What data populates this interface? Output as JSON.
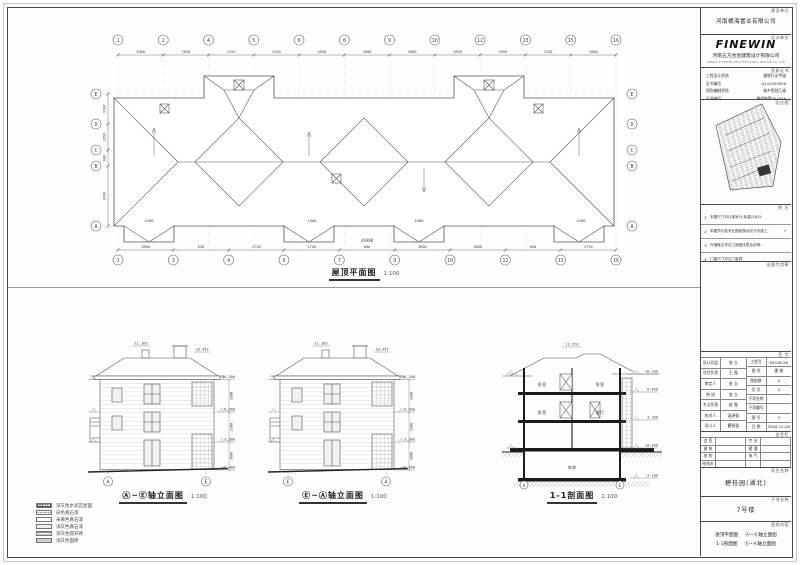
{
  "plan": {
    "title": "屋顶平面图",
    "scale": "1:100",
    "grid_top": [
      "1",
      "2",
      "4",
      "5",
      "6",
      "8",
      "9",
      "10",
      "12",
      "13",
      "15",
      "16"
    ],
    "dims_top": [
      "3000",
      "2850",
      "3150",
      "2550",
      "2850",
      "3000",
      "3000",
      "2850",
      "2850",
      "3150",
      "3000"
    ],
    "grid_bottom": [
      "1",
      "3",
      "4",
      "6",
      "7",
      "9",
      "10",
      "12",
      "13",
      "16"
    ],
    "dims_bottom": [
      "3600",
      "650",
      "2750",
      "2750",
      "600",
      "3600",
      "3600",
      "650",
      "2750"
    ],
    "grid_left": [
      "E",
      "D",
      "C",
      "B",
      "A"
    ],
    "grid_right": [
      "E",
      "D",
      "C",
      "B",
      "A"
    ],
    "dims_left": [
      "3300",
      "2850",
      "600",
      "4200"
    ],
    "total_width": "44400",
    "eave_offset": "1500"
  },
  "elevations": [
    {
      "title": "Ⓐ~Ⓔ轴立面图",
      "scale": "1:100",
      "bubble_left": "A",
      "bubble_right": "E",
      "levels_top": [
        "11.163",
        "10.453"
      ],
      "levels_right": [
        "10.200",
        "6.600",
        "3.300",
        "±0.000"
      ],
      "floor_dims": [
        "3300",
        "3300",
        "3600"
      ]
    },
    {
      "title": "Ⓔ~Ⓐ轴立面图",
      "scale": "1:100",
      "bubble_left": "E",
      "bubble_right": "A",
      "levels_top": [
        "11.163",
        "10.453"
      ],
      "levels_right": [
        "10.200",
        "6.600",
        "3.300",
        "±0.000"
      ],
      "floor_dims": [
        "3300",
        "3300",
        "3600"
      ]
    }
  ],
  "section": {
    "title": "1-1剖面图",
    "scale": "1:100",
    "ridge_level": "11.970",
    "rooms": [
      "卧室",
      "卧室",
      "卧室",
      "客厅",
      "车库"
    ],
    "levels": [
      "10.200",
      "6.600",
      "3.300",
      "±0.000",
      "-3.100"
    ],
    "bubble_left": "A",
    "bubble_right": "E"
  },
  "legend": {
    "items": [
      {
        "label": "深灰色水泥瓦屋面"
      },
      {
        "label": "白色真石漆"
      },
      {
        "label": "米黄色真石漆"
      },
      {
        "label": "浅灰色真石漆"
      },
      {
        "label": "深灰色劈开砖"
      },
      {
        "label": "浅灰色面砖"
      }
    ]
  },
  "titleblock": {
    "owner": {
      "tag": "建设单位",
      "name": "河南横海置业有限公司"
    },
    "designer": {
      "tag": "设计单位",
      "logo": "FINEWIN",
      "name": "河南五方合创建筑设计有限公司",
      "name_en": "HENAN FIVEWIN ARCHITECTURAL DESIGN CO.,LTD"
    },
    "cert": {
      "tag": "资质证书",
      "rows": [
        {
          "label": "工程设计资质",
          "value": "建筑行业甲级"
        },
        {
          "label": "证书编号",
          "value": "A141005956"
        },
        {
          "label": "规划编制资质",
          "value": "城乡规划乙级"
        },
        {
          "label": "证书编号",
          "value": "豫规编第094056"
        }
      ]
    },
    "keyplan": {
      "tag": "区位图"
    },
    "notes": {
      "tag": "附 注",
      "rows": [
        {
          "num": "1",
          "text": "本图尺寸均以毫米计,标高以米计.",
          "check": ""
        },
        {
          "num": "2",
          "text": "本图须与各专业图纸核对后方可施工.",
          "check": "✓"
        },
        {
          "num": "3",
          "text": "外墙做法详见工程做法表及说明.",
          "check": ""
        },
        {
          "num": "4",
          "text": "门窗尺寸详见门窗表.",
          "check": ""
        }
      ]
    },
    "stampbox": {
      "tag": "出图专用章"
    },
    "sign": {
      "tag": "签 字",
      "left": [
        {
          "label": "设计总监",
          "value": "张 立"
        },
        {
          "label": "项目负责",
          "value": "王 强"
        },
        {
          "label": "审定人",
          "value": "张 立"
        },
        {
          "label": "审 核",
          "value": "张 立"
        },
        {
          "label": "专业负责",
          "value": "赵 强"
        },
        {
          "label": "校对人",
          "value": "温泽强"
        },
        {
          "label": "设计人",
          "value": "曹智强"
        }
      ],
      "right": [
        {
          "label": "工程号",
          "value": "S2016-26"
        },
        {
          "label": "图 别",
          "value": "建 施"
        },
        {
          "label": "图纸数",
          "value": "4"
        },
        {
          "label": "页 次",
          "value": "3"
        },
        {
          "label": "子项名称",
          "value": ""
        },
        {
          "label": "子项编号",
          "value": ""
        },
        {
          "label": "图 号",
          "value": "3"
        },
        {
          "label": "日 期",
          "value": "2016-12-26"
        }
      ]
    },
    "disciplines": {
      "tag": "会签栏",
      "col1": [
        "会 签",
        "建 筑",
        "结 构",
        "给排水"
      ],
      "col2": [
        "专 业",
        "暖 通",
        "电 气",
        ""
      ]
    },
    "project": {
      "tag": "项目名称",
      "name": "碧桂园(湖北)"
    },
    "subproject": {
      "tag": "子项名称",
      "name": "7号楼"
    },
    "sheet": {
      "tag": "图纸内容",
      "line1_a": "屋顶平面图",
      "line1_b": "Ⓐ~Ⓔ轴立面图",
      "line2_a": "1-1剖面图",
      "line2_b": "Ⓔ~Ⓐ轴立面图"
    }
  }
}
